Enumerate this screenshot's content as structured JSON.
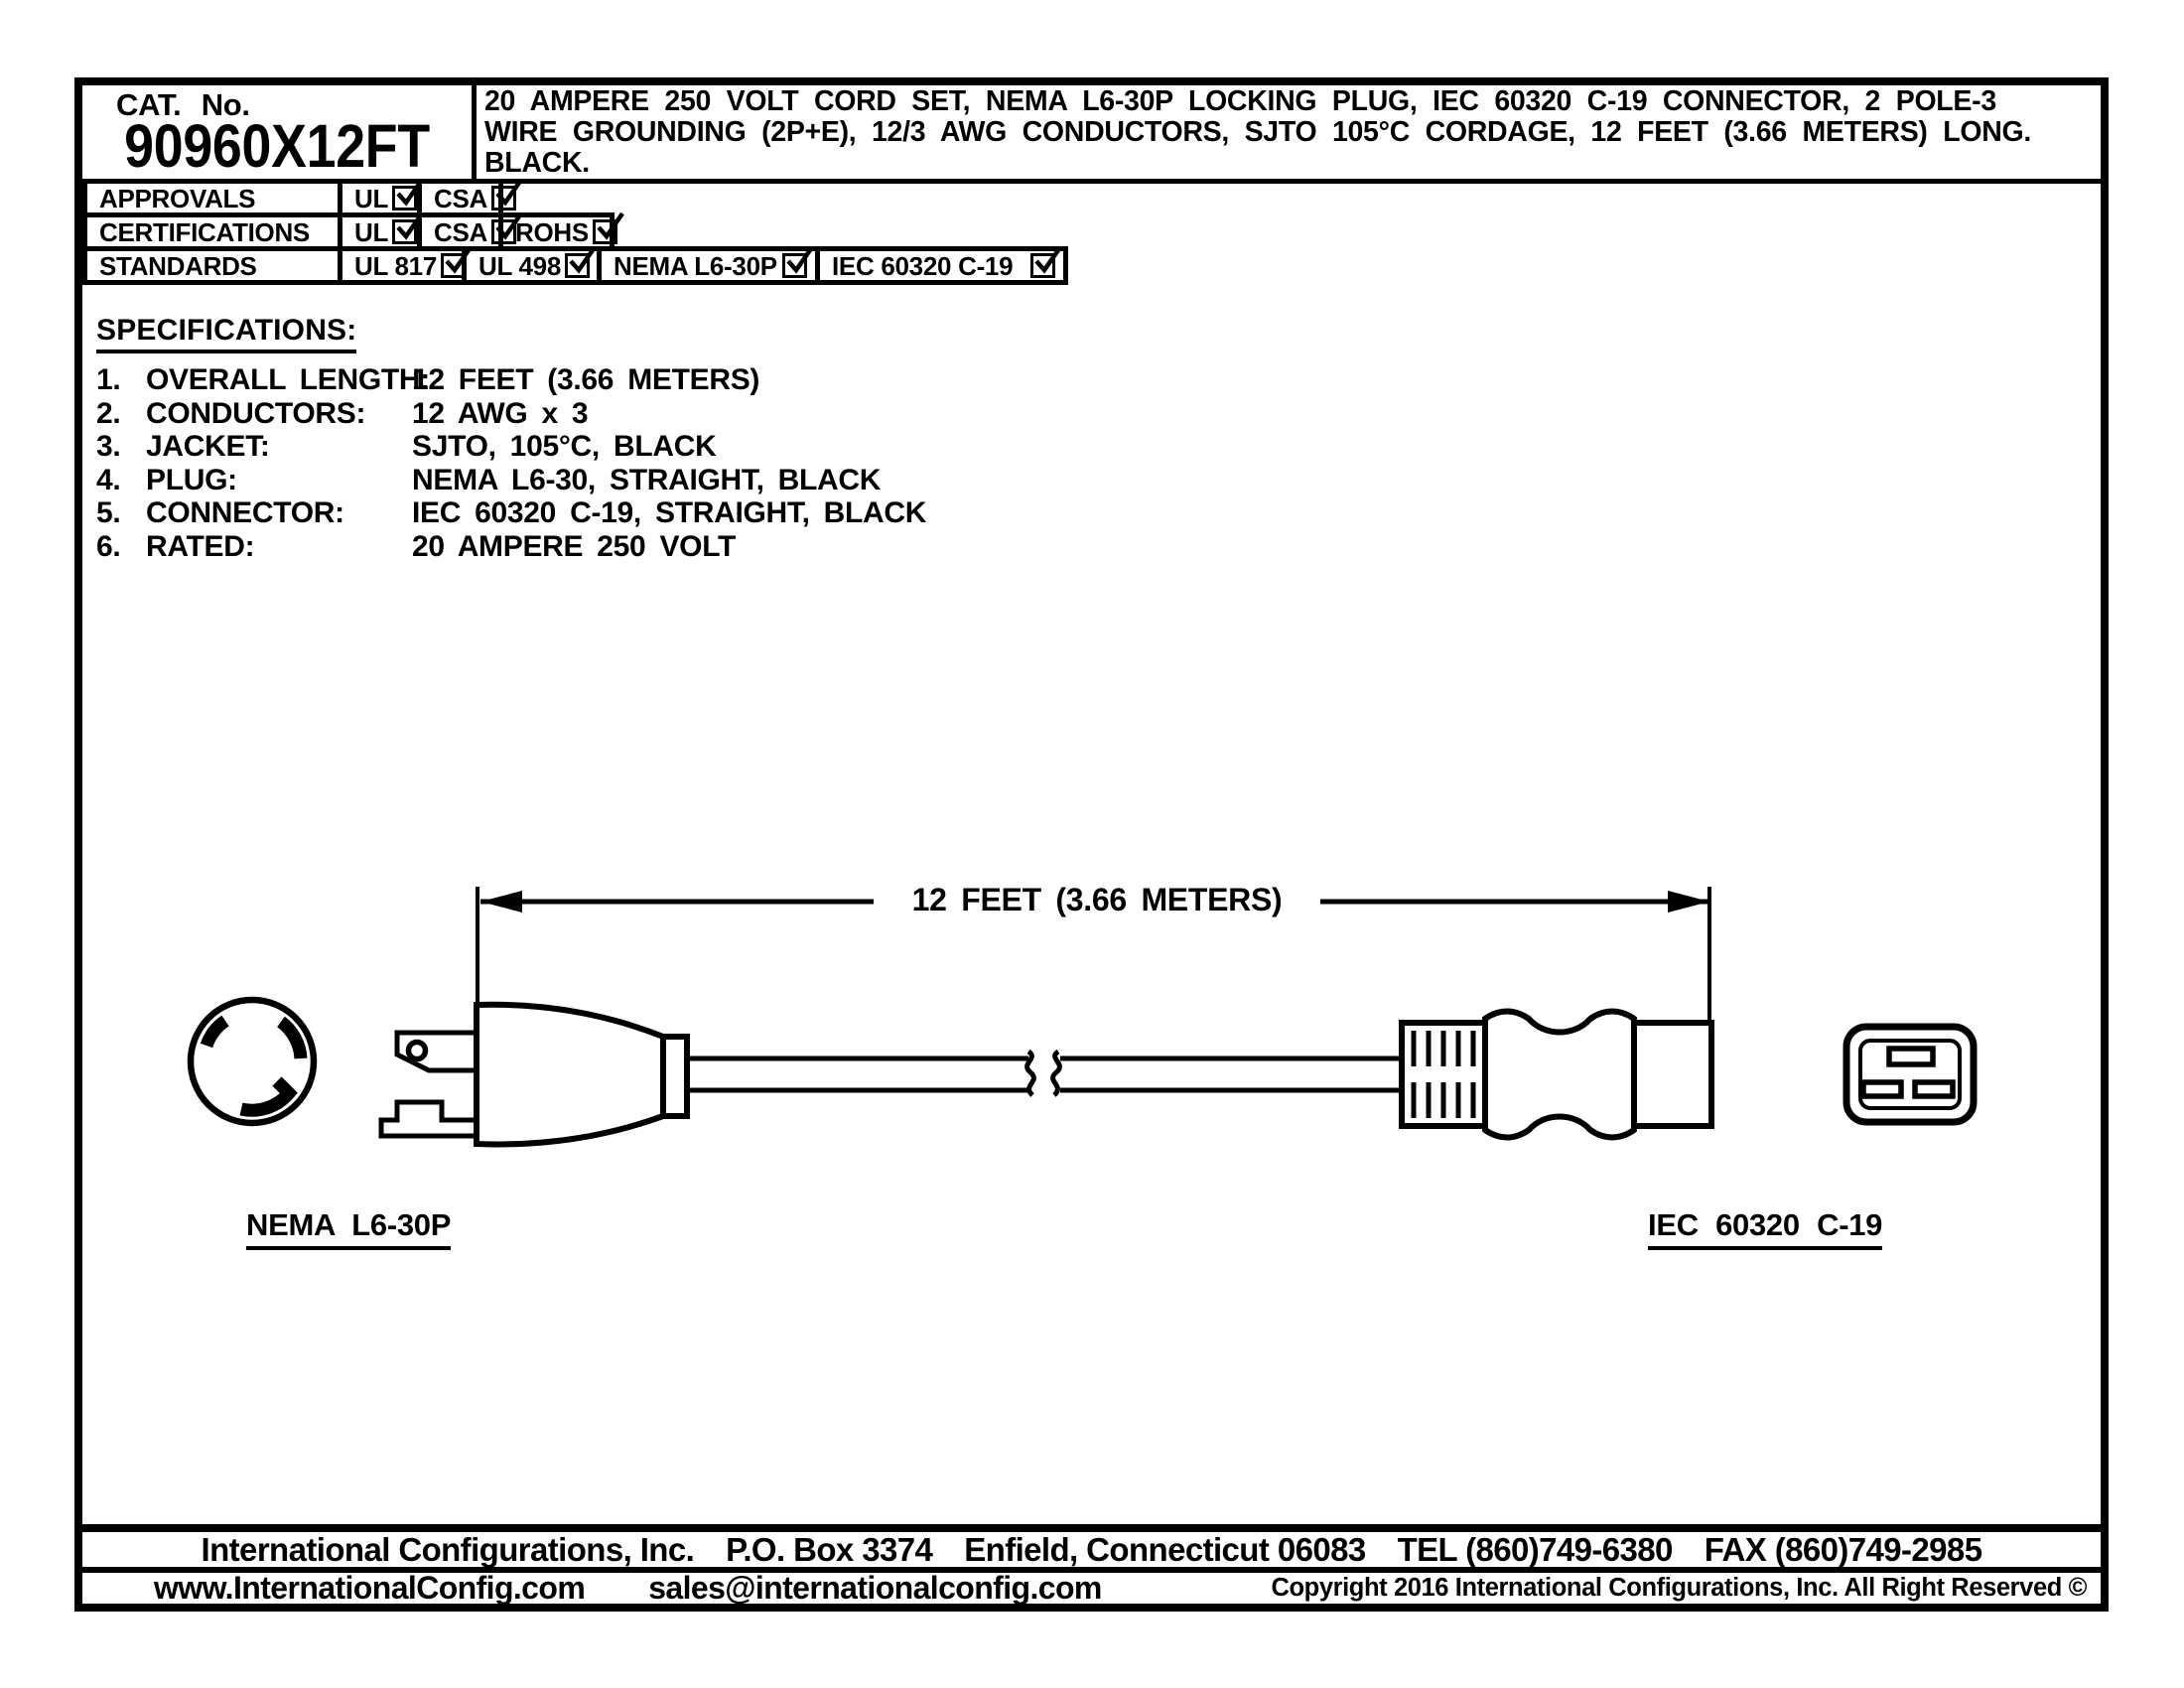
{
  "title_block": {
    "cat_label": "CAT. No.",
    "cat_number": "90960X12FT",
    "description_lines": [
      "20 AMPERE 250 VOLT CORD SET, NEMA L6-30P LOCKING PLUG, IEC 60320 C-19 CONNECTOR, 2 POLE-3",
      "WIRE GROUNDING (2P+E), 12/3 AWG CONDUCTORS, SJTO 105°C CORDAGE, 12 FEET (3.66 METERS) LONG.",
      "BLACK."
    ]
  },
  "compliance": {
    "rows": [
      {
        "label": "APPROVALS",
        "items": [
          {
            "label": "UL",
            "checked": true
          },
          {
            "label": "CSA",
            "checked": true
          }
        ]
      },
      {
        "label": "CERTIFICATIONS",
        "items": [
          {
            "label": "UL",
            "checked": true
          },
          {
            "label": "CSA",
            "checked": true
          },
          {
            "label": "ROHS",
            "checked": true
          }
        ]
      },
      {
        "label": "STANDARDS",
        "items": [
          {
            "label": "UL 817",
            "checked": true
          },
          {
            "label": "UL 498",
            "checked": true
          },
          {
            "label": "NEMA L6-30P",
            "checked": true
          },
          {
            "label": "IEC 60320 C-19",
            "checked": true
          }
        ]
      }
    ]
  },
  "specifications": {
    "heading": "SPECIFICATIONS:",
    "items": [
      {
        "num": "1.",
        "label": "OVERALL LENGTH:",
        "value": "12 FEET (3.66 METERS)"
      },
      {
        "num": "2.",
        "label": "CONDUCTORS:",
        "value": "12 AWG x 3"
      },
      {
        "num": "3.",
        "label": "JACKET:",
        "value": "SJTO, 105°C, BLACK"
      },
      {
        "num": "4.",
        "label": "PLUG:",
        "value": "NEMA L6-30, STRAIGHT, BLACK"
      },
      {
        "num": "5.",
        "label": "CONNECTOR:",
        "value": "IEC 60320 C-19, STRAIGHT, BLACK"
      },
      {
        "num": "6.",
        "label": "RATED:",
        "value": "20 AMPERE 250 VOLT"
      }
    ]
  },
  "drawing": {
    "dimension_label": "12 FEET (3.66 METERS)",
    "plug_label": "NEMA L6-30P",
    "connector_label": "IEC 60320 C-19"
  },
  "footer": {
    "line1_segments": [
      "International Configurations, Inc.",
      "P.O. Box 3374",
      "Enfield, Connecticut 06083",
      "TEL (860)749-6380",
      "FAX (860)749-2985"
    ],
    "website": "www.InternationalConfig.com",
    "email": "sales@internationalconfig.com",
    "copyright": "Copyright 2016 International Configurations, Inc. All Right Reserved ©"
  },
  "colors": {
    "ink": "#000000",
    "paper": "#ffffff"
  }
}
